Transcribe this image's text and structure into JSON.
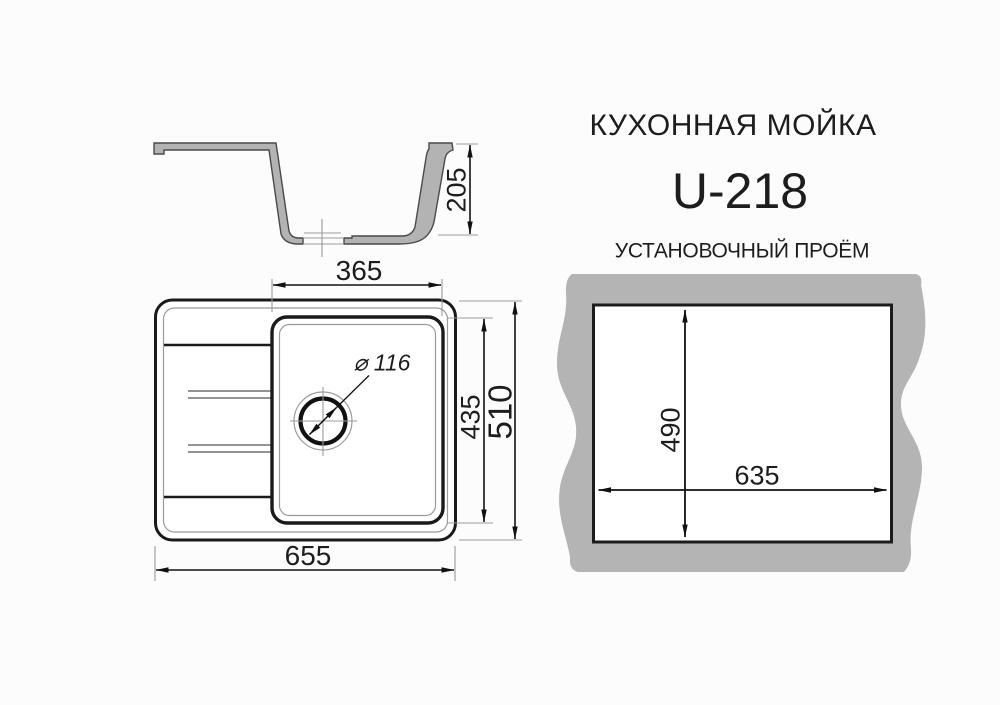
{
  "header": {
    "title": "КУХОННАЯ МОЙКА",
    "model": "U-218",
    "subtitle": "УСТАНОВОЧНЫЙ ПРОЁМ"
  },
  "section_view": {
    "depth_mm": "205"
  },
  "top_view": {
    "overall_width_mm": "655",
    "overall_depth_mm": "510",
    "bowl_width_mm": "365",
    "bowl_depth_mm": "435",
    "drain_diameter": "⌀ 116"
  },
  "cutout_view": {
    "width_mm": "635",
    "height_mm": "490"
  },
  "colors": {
    "thick_line": "#1a1a1a",
    "thin_line": "#9b9b9b",
    "dim_line": "#111111",
    "countertop_gray": "#b4b4b4",
    "profile_fill": "#b3b3b3",
    "profile_stroke": "#4a4a4a"
  }
}
